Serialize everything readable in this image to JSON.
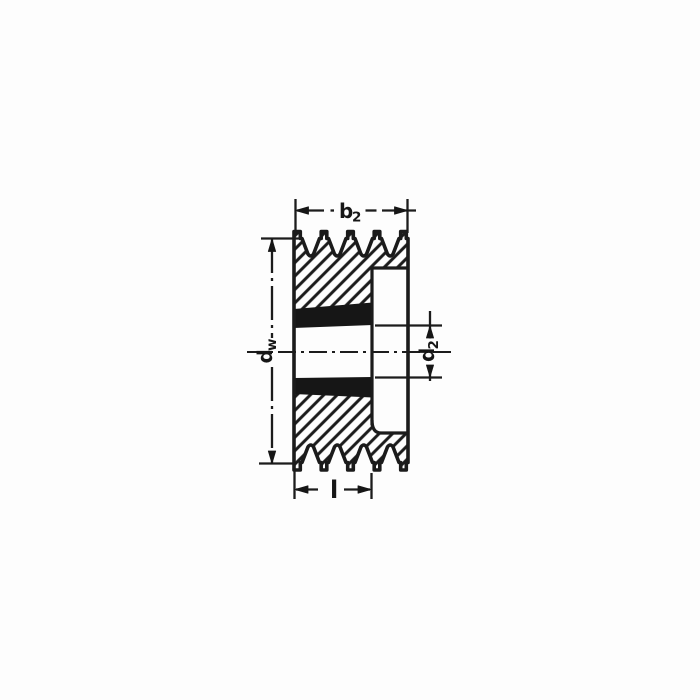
{
  "figure": {
    "type": "technical-drawing",
    "subject": "v-belt pulley cross-section, 4 grooves, taper bush hub",
    "colors": {
      "ink": "#1b1b1b",
      "paper": "#fdfdfd"
    },
    "dimensions": {
      "rim_width": {
        "main": "b",
        "sub": "2"
      },
      "outer_diameter": {
        "main": "d",
        "sub": "w"
      },
      "bore_diameter": {
        "main": "d",
        "sub": "2"
      },
      "hub_length": {
        "main": "l",
        "sub": ""
      }
    }
  }
}
